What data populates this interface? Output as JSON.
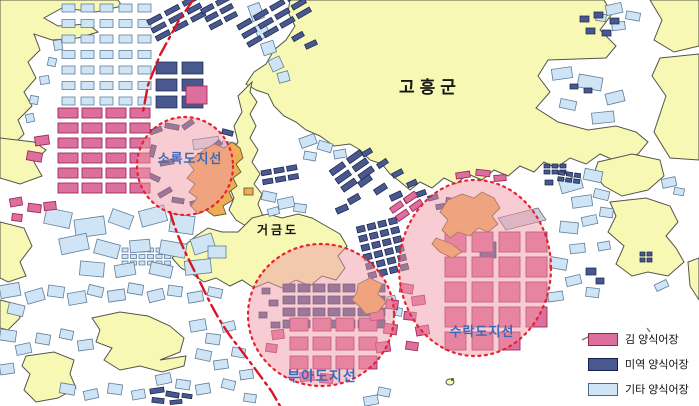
{
  "map": {
    "county_label": "고흥군",
    "island_label": "거금도",
    "zones": [
      {
        "id": "sorokdo",
        "label": "소록도지선"
      },
      {
        "id": "buado",
        "label": "부아도지선"
      },
      {
        "id": "surakdo",
        "label": "수락도지선"
      }
    ]
  },
  "legend": {
    "items": [
      {
        "id": "kim",
        "label": "김 양식어장",
        "color": "#dd6f9e"
      },
      {
        "id": "miyeok",
        "label": "미역 양식어장",
        "color": "#49598f"
      },
      {
        "id": "gita",
        "label": "기타 양식어장",
        "color": "#cfe4f4"
      }
    ]
  },
  "colors": {
    "sea": "#ffffff",
    "land": "#f6f8b4",
    "zone_fill": "#ef9aa6",
    "zone_border": "#e82230",
    "boundary_line": "#dc1422",
    "orange_island": "#efac57",
    "zone_label": "#3c68ba",
    "text": "#161616"
  }
}
